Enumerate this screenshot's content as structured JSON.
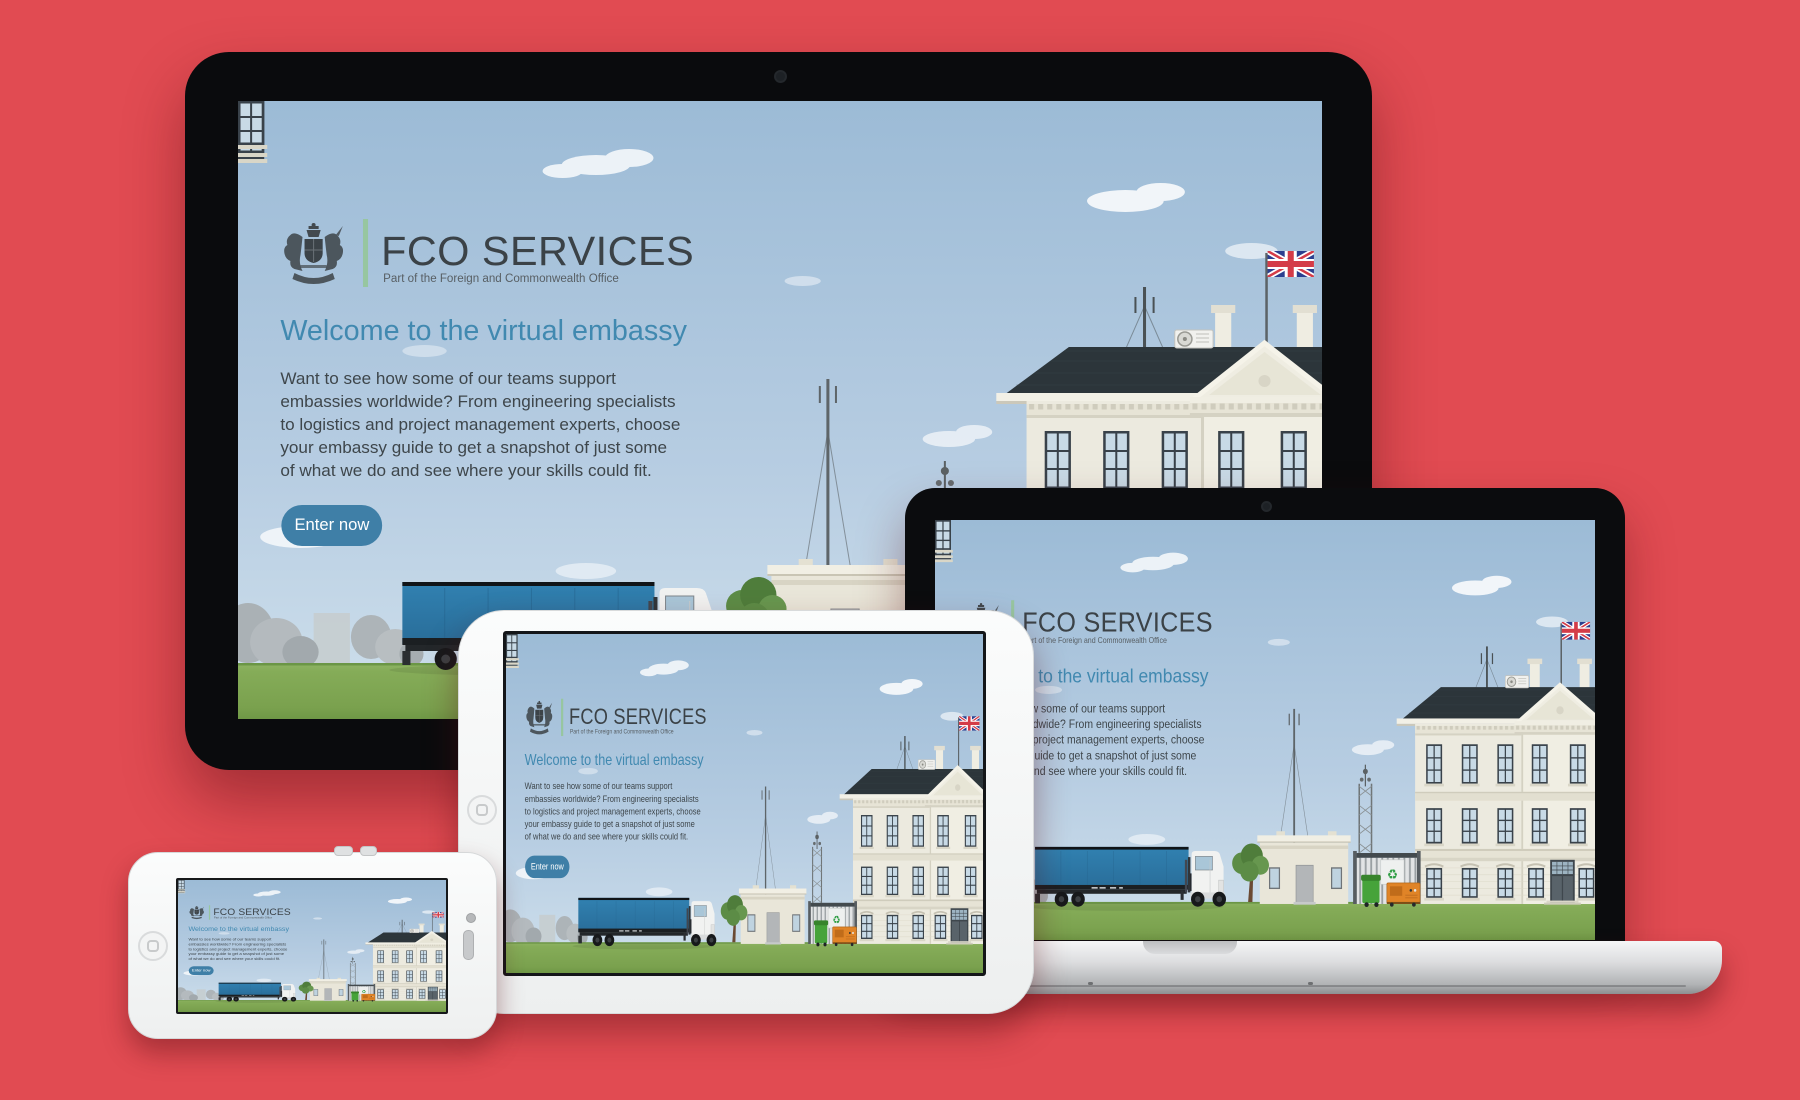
{
  "page_background": "#e14b52",
  "brand": {
    "crest_icon": "royal-coat-of-arms-icon",
    "name": "FCO SERVICES",
    "tagline": "Part of the Foreign and Commonwealth Office",
    "colors": {
      "name": "#3b4247",
      "tagline": "#585f64",
      "divider": "#97c6a0"
    }
  },
  "hero": {
    "headline": "Welcome to the virtual embassy",
    "body": "Want to see how some of our teams support embassies worldwide? From engineering specialists to logistics and project management experts, choose your embassy guide to get a snapshot of just some of what we do and see where your skills could fit.",
    "cta_label": "Enter now",
    "colors": {
      "headline": "#4189b0",
      "body": "#3e464b",
      "cta_background": "#3f7fa7",
      "cta_text": "#ffffff"
    }
  },
  "devices": [
    {
      "type": "desktop-monitor",
      "parts": [
        "black-bezel",
        "webcam-dot"
      ]
    },
    {
      "type": "laptop",
      "parts": [
        "black-bezel",
        "webcam-dot",
        "aluminum-base",
        "thumb-scoop-notch"
      ]
    },
    {
      "type": "tablet",
      "parts": [
        "white-bezel",
        "home-button"
      ]
    },
    {
      "type": "smartphone",
      "parts": [
        "white-bezel",
        "home-button",
        "front-camera",
        "earpiece-speaker",
        "volume-buttons"
      ]
    }
  ],
  "scene": {
    "elements": [
      "sky",
      "clouds",
      "tree-silhouettes",
      "grass",
      "articulated-truck",
      "tree",
      "gatehouse",
      "small-antenna-mast",
      "lattice-antenna-tower",
      "security-fence",
      "recycling-box",
      "green-wheelie-bin",
      "generator-unit",
      "embassy-building",
      "pediment",
      "union-jack-flag",
      "roof-antenna-mast",
      "air-conditioning-unit",
      "chimneys"
    ],
    "colors": {
      "sky_top": "#9cbbd6",
      "sky_bottom": "#cfe0ec",
      "grass": "#83aa56",
      "roof": "#2c353a",
      "wall": "#eceadf",
      "trailer_blue": "#2f7cab"
    }
  }
}
